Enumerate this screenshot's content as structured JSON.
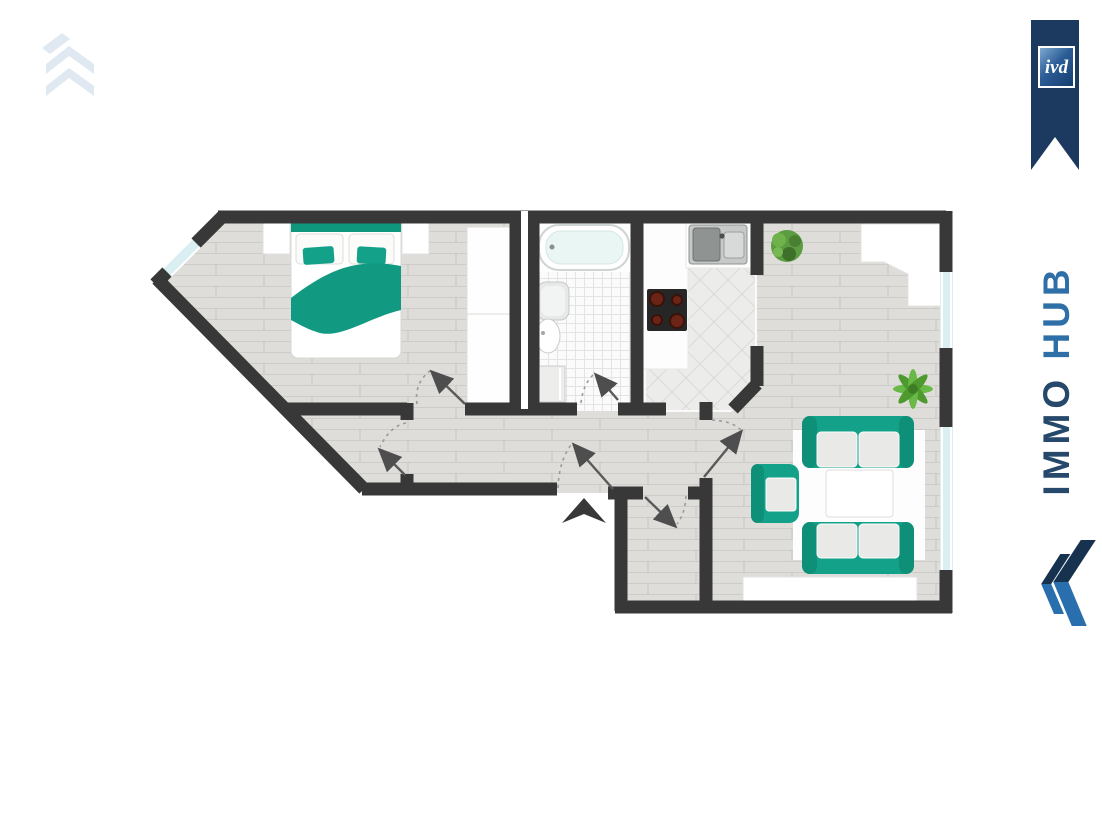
{
  "branding": {
    "watermark_logo": {
      "icon": "double-chevron-up-watermark",
      "color": "#c7d8e8"
    },
    "ivd_badge": {
      "label": "ivd",
      "ribbon_color": "#1c3a60",
      "square_gradient": [
        "#7da9d2",
        "#143d6e"
      ]
    },
    "wordmark": {
      "immo": "IMMO",
      "hub": "HUB",
      "immo_color": "#25486b",
      "hub_color": "#2f6fa8"
    },
    "brand_logo": {
      "icon": "double-chevron-left",
      "colors": [
        "#16324f",
        "#2a6fad"
      ]
    }
  },
  "floor_plan": {
    "wall_color": "#383838",
    "accent_teal": "#14a189",
    "window_glass_color": "#d9eff2",
    "windows": 3,
    "doors": 6,
    "entrance_marker": "black-triangle-arrow-up",
    "rooms": [
      {
        "name": "bedroom",
        "floor": "wood-planks",
        "furniture": [
          "double-bed",
          "two-pillows",
          "teal-blanket",
          "nightstand-left",
          "nightstand-right",
          "wardrobe"
        ]
      },
      {
        "name": "bathroom",
        "floor": "white-tile-grid",
        "furniture": [
          "bathtub",
          "washbasin",
          "toilet",
          "washing-machine"
        ]
      },
      {
        "name": "kitchen",
        "floor": "diagonal-stone-tile",
        "furniture": [
          "counter-l-shape",
          "double-sink",
          "stove-four-burners"
        ]
      },
      {
        "name": "living-room",
        "floor": "wood-planks",
        "furniture": [
          "sofa-top",
          "sofa-bottom",
          "armchair",
          "coffee-table",
          "rug",
          "sideboard",
          "corner-cabinet",
          "round-plant",
          "palm-plant"
        ]
      },
      {
        "name": "hallway",
        "floor": "wood-planks",
        "furniture": []
      },
      {
        "name": "vestibule",
        "floor": "wood-planks",
        "furniture": []
      }
    ]
  }
}
